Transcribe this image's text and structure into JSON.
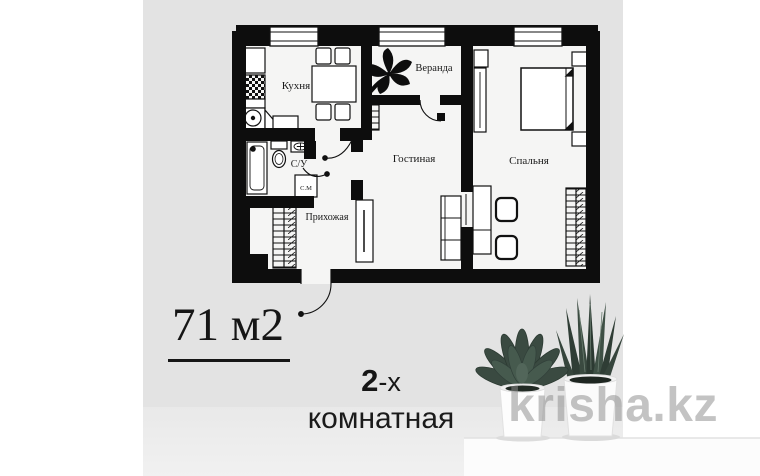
{
  "plan": {
    "rooms": {
      "kitchen": "Кухня",
      "veranda": "Веранда",
      "living_room": "Гостиная",
      "bedroom": "Спальня",
      "bathroom": "С/У",
      "washing_machine": "С.М",
      "hallway": "Прихожая"
    }
  },
  "info": {
    "area": "71 м2",
    "rooms_count": "2",
    "rooms_suffix": "-х",
    "rooms_word": "комнатная"
  },
  "watermark": {
    "text": "krisha.kz"
  },
  "colors": {
    "wall": "#111111",
    "panel_gray": "#e3e3e3",
    "plan_floor": "#f5f5f4",
    "plant_green": "#3a4a41",
    "watermark_gray": "#8e8e8e"
  }
}
